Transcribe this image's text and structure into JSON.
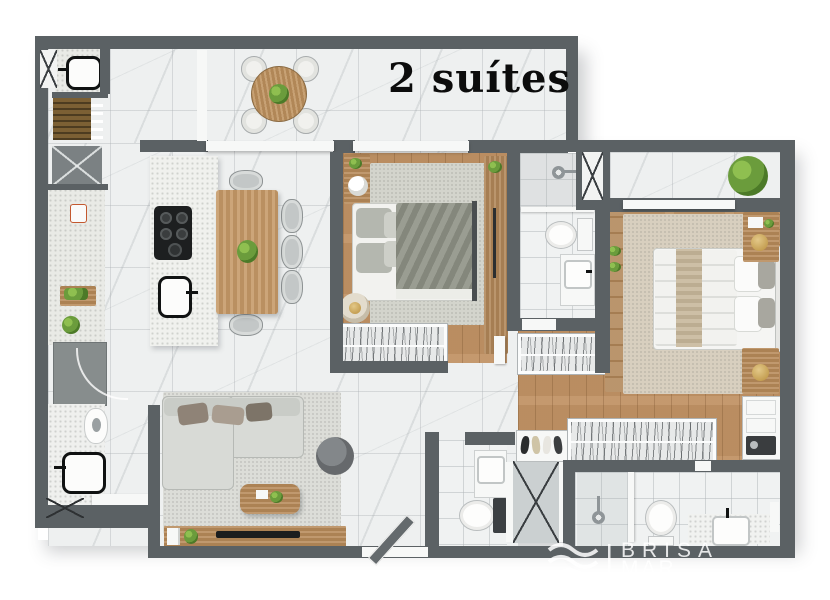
{
  "title": "2 suítes",
  "watermark": {
    "brand_line1": "BRISA",
    "brand_line2": "MAR IMÓVEIS",
    "icon": "waves-icon"
  },
  "palette": {
    "background": "#ffffff",
    "wall_gray": "#5b6164",
    "marble_floor": "#eef0f0",
    "wood_floor": "#c19365",
    "counter_speckle": "#e9eae6",
    "suite1_duvet": "#8f9286",
    "suite2_runner": "#c6b69a",
    "sofa_gray": "#d8dad6",
    "plant_green": "#6b9c3c",
    "title_text": "#0c0c0c",
    "watermark_text": "#ffffff"
  },
  "floorplan": {
    "kind": "apartment top-view 3D render",
    "suites_count": 2,
    "rooms": [
      {
        "name": "balcony",
        "furniture": [
          "round-wood-table",
          "chairs-x4",
          "table-plant",
          "sliding-window"
        ]
      },
      {
        "name": "laundry",
        "furniture": [
          "utility-sink",
          "drying-grate",
          "duct-shaft-x"
        ]
      },
      {
        "name": "kitchen",
        "furniture": [
          "side-counter",
          "mug",
          "cutting-board",
          "herb-plant",
          "appliance-cabinet",
          "island-cooktop",
          "island-sink"
        ]
      },
      {
        "name": "dining",
        "furniture": [
          "wood-table",
          "chairs-x5",
          "center-plant"
        ]
      },
      {
        "name": "living",
        "furniture": [
          "l-shaped-sofa",
          "throw-pillows",
          "coffee-table",
          "round-pouf",
          "tv-console",
          "tv",
          "entry-door"
        ]
      },
      {
        "name": "wc",
        "furniture": [
          "black-sink",
          "toilet",
          "bench"
        ]
      },
      {
        "name": "suite-1",
        "furniture": [
          "double-bed",
          "gray-duvet",
          "rug",
          "nightstand",
          "table-lamp",
          "hanger-wardrobe",
          "tall-wardrobe",
          "candle-pouf"
        ]
      },
      {
        "name": "bathroom-suite-1",
        "furniture": [
          "shower",
          "toilet",
          "vanity-sink",
          "duct-shaft-x"
        ]
      },
      {
        "name": "hall",
        "furniture": [
          "hanger-closet",
          "toilet-room-sink",
          "toilet",
          "duct-shaft-x"
        ]
      },
      {
        "name": "suite-2",
        "furniture": [
          "double-bed",
          "white-duvet",
          "rug",
          "nightstand-x2",
          "side-cabinet",
          "shoe-rack",
          "hanger-wardrobe",
          "dresser",
          "balcony-plant",
          "sliding-window"
        ]
      },
      {
        "name": "bathroom-suite-2",
        "furniture": [
          "shower",
          "toilet",
          "vanity-sink",
          "towel"
        ]
      }
    ]
  }
}
